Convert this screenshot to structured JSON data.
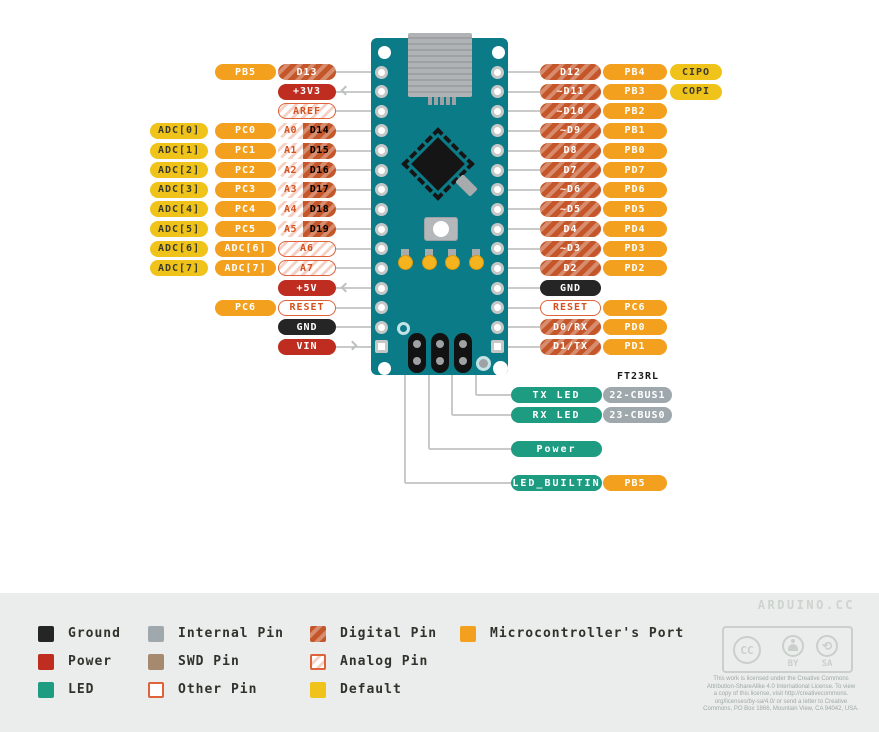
{
  "colors": {
    "port": "#F2A01E",
    "digital": "#C4562A",
    "analog_border": "#DE623A",
    "analog_text": "#D5521F",
    "power": "#BE2D20",
    "ground": "#252526",
    "led": "#1E9C82",
    "internal": "#9FA8AC",
    "default": "#EFC31A",
    "default_text": "#3A3A2E",
    "swd": "#A68A70",
    "board": "#0C7B88",
    "trace": "#C9CBCB",
    "legend_bg": "#EAEDEC",
    "brand_text": "#CDD3CF",
    "license_text": "#9FA9A5"
  },
  "left_rows": [
    {
      "port": "PB5",
      "pins": [
        {
          "label": "D13",
          "type": "digital"
        }
      ]
    },
    {
      "pins": [
        {
          "label": "+3V3",
          "type": "power"
        }
      ],
      "arrow": "out"
    },
    {
      "pins": [
        {
          "label": "AREF",
          "type": "analog"
        }
      ]
    },
    {
      "adc": "ADC[0]",
      "port": "PC0",
      "combo": [
        {
          "label": "A0",
          "type": "analog"
        },
        {
          "label": "D14",
          "type": "digital"
        }
      ]
    },
    {
      "adc": "ADC[1]",
      "port": "PC1",
      "combo": [
        {
          "label": "A1",
          "type": "analog"
        },
        {
          "label": "D15",
          "type": "digital"
        }
      ]
    },
    {
      "adc": "ADC[2]",
      "port": "PC2",
      "combo": [
        {
          "label": "A2",
          "type": "analog"
        },
        {
          "label": "D16",
          "type": "digital"
        }
      ]
    },
    {
      "adc": "ADC[3]",
      "port": "PC3",
      "combo": [
        {
          "label": "A3",
          "type": "analog"
        },
        {
          "label": "D17",
          "type": "digital"
        }
      ]
    },
    {
      "adc": "ADC[4]",
      "port": "PC4",
      "combo": [
        {
          "label": "A4",
          "type": "analog"
        },
        {
          "label": "D18",
          "type": "digital"
        }
      ]
    },
    {
      "adc": "ADC[5]",
      "port": "PC5",
      "combo": [
        {
          "label": "A5",
          "type": "analog"
        },
        {
          "label": "D19",
          "type": "digital"
        }
      ]
    },
    {
      "adc": "ADC[6]",
      "port": "ADC[6]",
      "pins": [
        {
          "label": "A6",
          "type": "analog"
        }
      ]
    },
    {
      "adc": "ADC[7]",
      "port": "ADC[7]",
      "pins": [
        {
          "label": "A7",
          "type": "analog"
        }
      ]
    },
    {
      "pins": [
        {
          "label": "+5V",
          "type": "power"
        }
      ],
      "arrow": "out"
    },
    {
      "port": "PC6",
      "pins": [
        {
          "label": "RESET",
          "type": "other"
        }
      ]
    },
    {
      "pins": [
        {
          "label": "GND",
          "type": "ground"
        }
      ]
    },
    {
      "pins": [
        {
          "label": "VIN",
          "type": "power"
        }
      ],
      "arrow": "in"
    }
  ],
  "right_rows": [
    {
      "pin": {
        "label": "D12",
        "type": "digital"
      },
      "port": "PB4",
      "extra": "CIPO"
    },
    {
      "pin": {
        "label": "~D11",
        "type": "digital"
      },
      "port": "PB3",
      "extra": "COPI"
    },
    {
      "pin": {
        "label": "~D10",
        "type": "digital"
      },
      "port": "PB2"
    },
    {
      "pin": {
        "label": "~D9",
        "type": "digital"
      },
      "port": "PB1"
    },
    {
      "pin": {
        "label": "D8",
        "type": "digital"
      },
      "port": "PB0"
    },
    {
      "pin": {
        "label": "D7",
        "type": "digital"
      },
      "port": "PD7"
    },
    {
      "pin": {
        "label": "~D6",
        "type": "digital"
      },
      "port": "PD6"
    },
    {
      "pin": {
        "label": "~D5",
        "type": "digital"
      },
      "port": "PD5"
    },
    {
      "pin": {
        "label": "D4",
        "type": "digital"
      },
      "port": "PD4"
    },
    {
      "pin": {
        "label": "~D3",
        "type": "digital"
      },
      "port": "PD3"
    },
    {
      "pin": {
        "label": "D2",
        "type": "digital"
      },
      "port": "PD2"
    },
    {
      "pin": {
        "label": "GND",
        "type": "ground"
      }
    },
    {
      "pin": {
        "label": "RESET",
        "type": "other"
      },
      "port": "PC6"
    },
    {
      "pin": {
        "label": "D0/RX",
        "type": "digital"
      },
      "port": "PD0"
    },
    {
      "pin": {
        "label": "D1/TX",
        "type": "digital"
      },
      "port": "PD1"
    }
  ],
  "callouts": {
    "chip_label": "FT23RL",
    "rows": [
      {
        "label": "TX LED",
        "type": "led",
        "extra": "22-CBUS1",
        "extra_type": "internal"
      },
      {
        "label": "RX LED",
        "type": "led",
        "extra": "23-CBUS0",
        "extra_type": "internal"
      },
      {
        "label": "Power",
        "type": "led"
      },
      {
        "label": "LED_BUILTIN",
        "type": "led",
        "extra": "PB5",
        "extra_type": "port"
      }
    ]
  },
  "legend": {
    "items": [
      {
        "label": "Ground",
        "type": "ground"
      },
      {
        "label": "Power",
        "type": "power"
      },
      {
        "label": "LED",
        "type": "led"
      },
      {
        "label": "Internal Pin",
        "type": "internal"
      },
      {
        "label": "SWD Pin",
        "type": "swd"
      },
      {
        "label": "Other Pin",
        "type": "other"
      },
      {
        "label": "Digital Pin",
        "type": "digital"
      },
      {
        "label": "Analog Pin",
        "type": "analog"
      },
      {
        "label": "Default",
        "type": "default"
      },
      {
        "label": "Microcontroller's Port",
        "type": "port"
      }
    ]
  },
  "footer": {
    "brand": "ARDUINO.CC",
    "badge": {
      "cc": "CC",
      "by": "BY",
      "sa": "SA"
    },
    "license_lines": [
      "This work is licensed under the Creative Commons",
      "Attribution-ShareAlike 4.0 International License. To view",
      "a copy of this license, visit http://creativecommons.",
      "org/licenses/by-sa/4.0/ or send a letter to Creative",
      "Commons, PO Box 1866, Mountain View, CA 94042, USA."
    ]
  }
}
